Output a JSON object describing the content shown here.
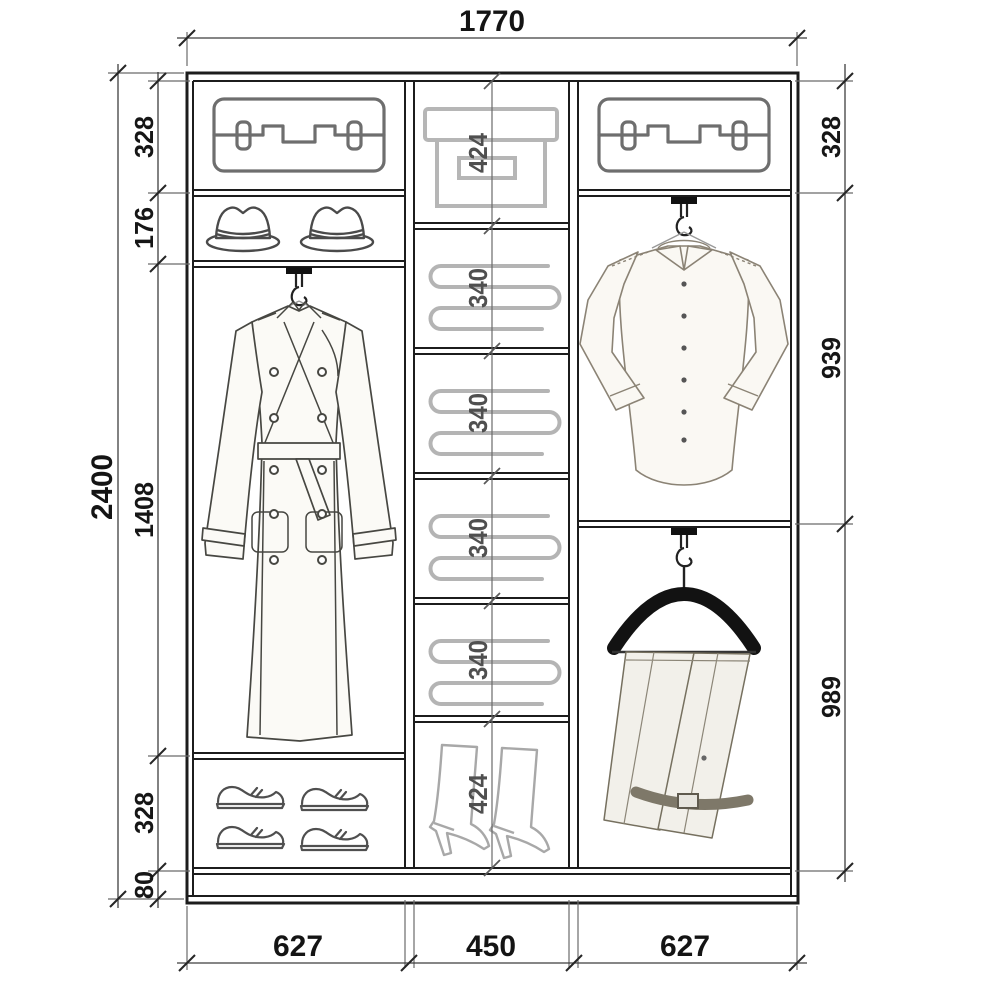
{
  "drawing": {
    "kind": "wardrobe-interior-elevation"
  },
  "dims": {
    "overall_width": "1770",
    "overall_height": "2400",
    "left": [
      "328",
      "176",
      "1408",
      "328",
      "80"
    ],
    "center": [
      "424",
      "340",
      "340",
      "340",
      "340",
      "424"
    ],
    "right": [
      "328",
      "939",
      "989"
    ],
    "bottom": [
      "627",
      "450",
      "627"
    ]
  },
  "icons": {
    "left_column": [
      "suitcase",
      "hats",
      "trench-coat-on-hanger",
      "shoes"
    ],
    "center_column": [
      "storage-box",
      "folded-linens",
      "folded-linens",
      "folded-linens",
      "folded-linens",
      "high-boots"
    ],
    "right_column": [
      "suitcase",
      "shirt-on-hanger",
      "trousers-on-hanger"
    ]
  },
  "colors": {
    "background": "#ffffff",
    "frame_line": "#1c1c1c",
    "dimension_line": "#3f3f3f",
    "dimension_text": "#141414",
    "center_dimension_text": "#4f4f4f",
    "light_icon": "#b4b4b4",
    "dark_icon": "#4f4f4f"
  }
}
